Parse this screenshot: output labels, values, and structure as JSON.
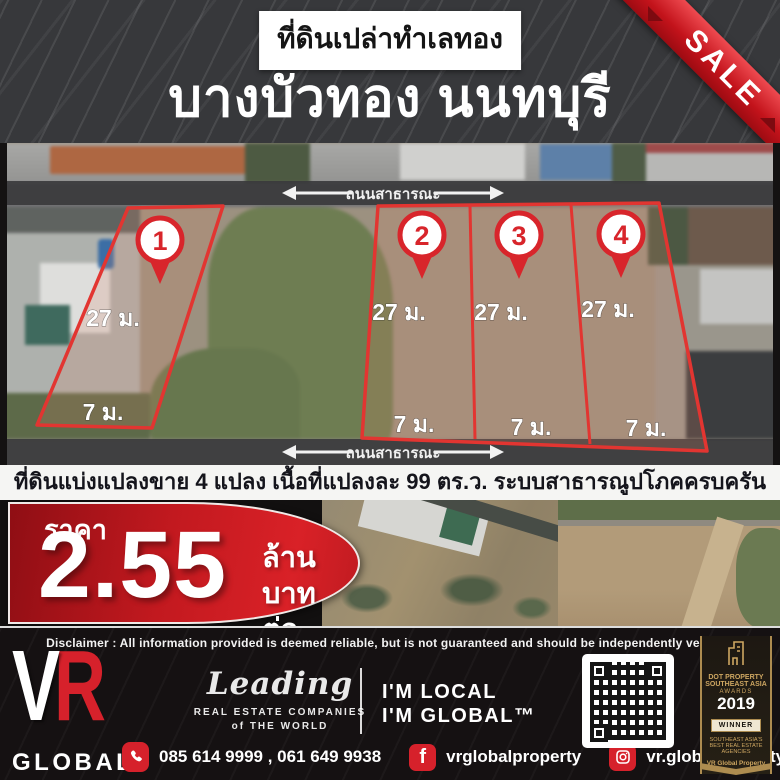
{
  "header": {
    "badge": "ที่ดินเปล่าทำเลทอง",
    "title": "บางบัวทอง นนทบุรี",
    "sale_ribbon": "SALE"
  },
  "map": {
    "road_top": "ถนนสาธารณะ",
    "road_bottom": "ถนนสาธารณะ",
    "plots": [
      {
        "num": "1",
        "depth": "27 ม.",
        "frontage": "7 ม."
      },
      {
        "num": "2",
        "depth": "27 ม.",
        "frontage": "7 ม."
      },
      {
        "num": "3",
        "depth": "27 ม.",
        "frontage": "7 ม."
      },
      {
        "num": "4",
        "depth": "27 ม.",
        "frontage": "7 ม."
      }
    ]
  },
  "summary": "ที่ดินแบ่งแปลงขาย 4 แปลง เนื้อที่แปลงละ 99 ตร.ว. ระบบสาธารณูปโภคครบครัน",
  "price": {
    "label": "ราคา",
    "amount": "2.55",
    "unit_line1": "ล้านบาท",
    "unit_line2": "ต่อแปลง"
  },
  "disclaimer": "Disclaimer :  All information provided is deemed reliable, but is not guaranteed and should be independently verified.",
  "footer": {
    "logo": {
      "v": "V",
      "r": "R",
      "global": "GLOBAL",
      "property": "P R O P E R T Y"
    },
    "leading": {
      "script": "Leading",
      "line1": "REAL ESTATE COMPANIES",
      "line2": "of THE WORLD"
    },
    "local_global": {
      "line1": "I'M LOCAL",
      "line2": "I'M GLOBAL™"
    },
    "award": {
      "line1": "DOT PROPERTY",
      "line2": "SOUTHEAST ASIA",
      "line3": "AWARDS",
      "year": "2019",
      "winner": "WINNER",
      "line4": "SOUTHEAST ASIA'S",
      "line5": "BEST REAL ESTATE AGENCIES",
      "line6": "VR Global Property"
    },
    "contact": {
      "phones": "085 614 9999 , 061 649 9938",
      "facebook": "vrglobalproperty",
      "instagram": "vr.globalproperty",
      "facebook_letter": "f"
    }
  },
  "colors": {
    "accent_red": "#d6212b",
    "plot_outline": "#e23531",
    "gold": "#ad8c50",
    "header_bg": "#37383b"
  }
}
